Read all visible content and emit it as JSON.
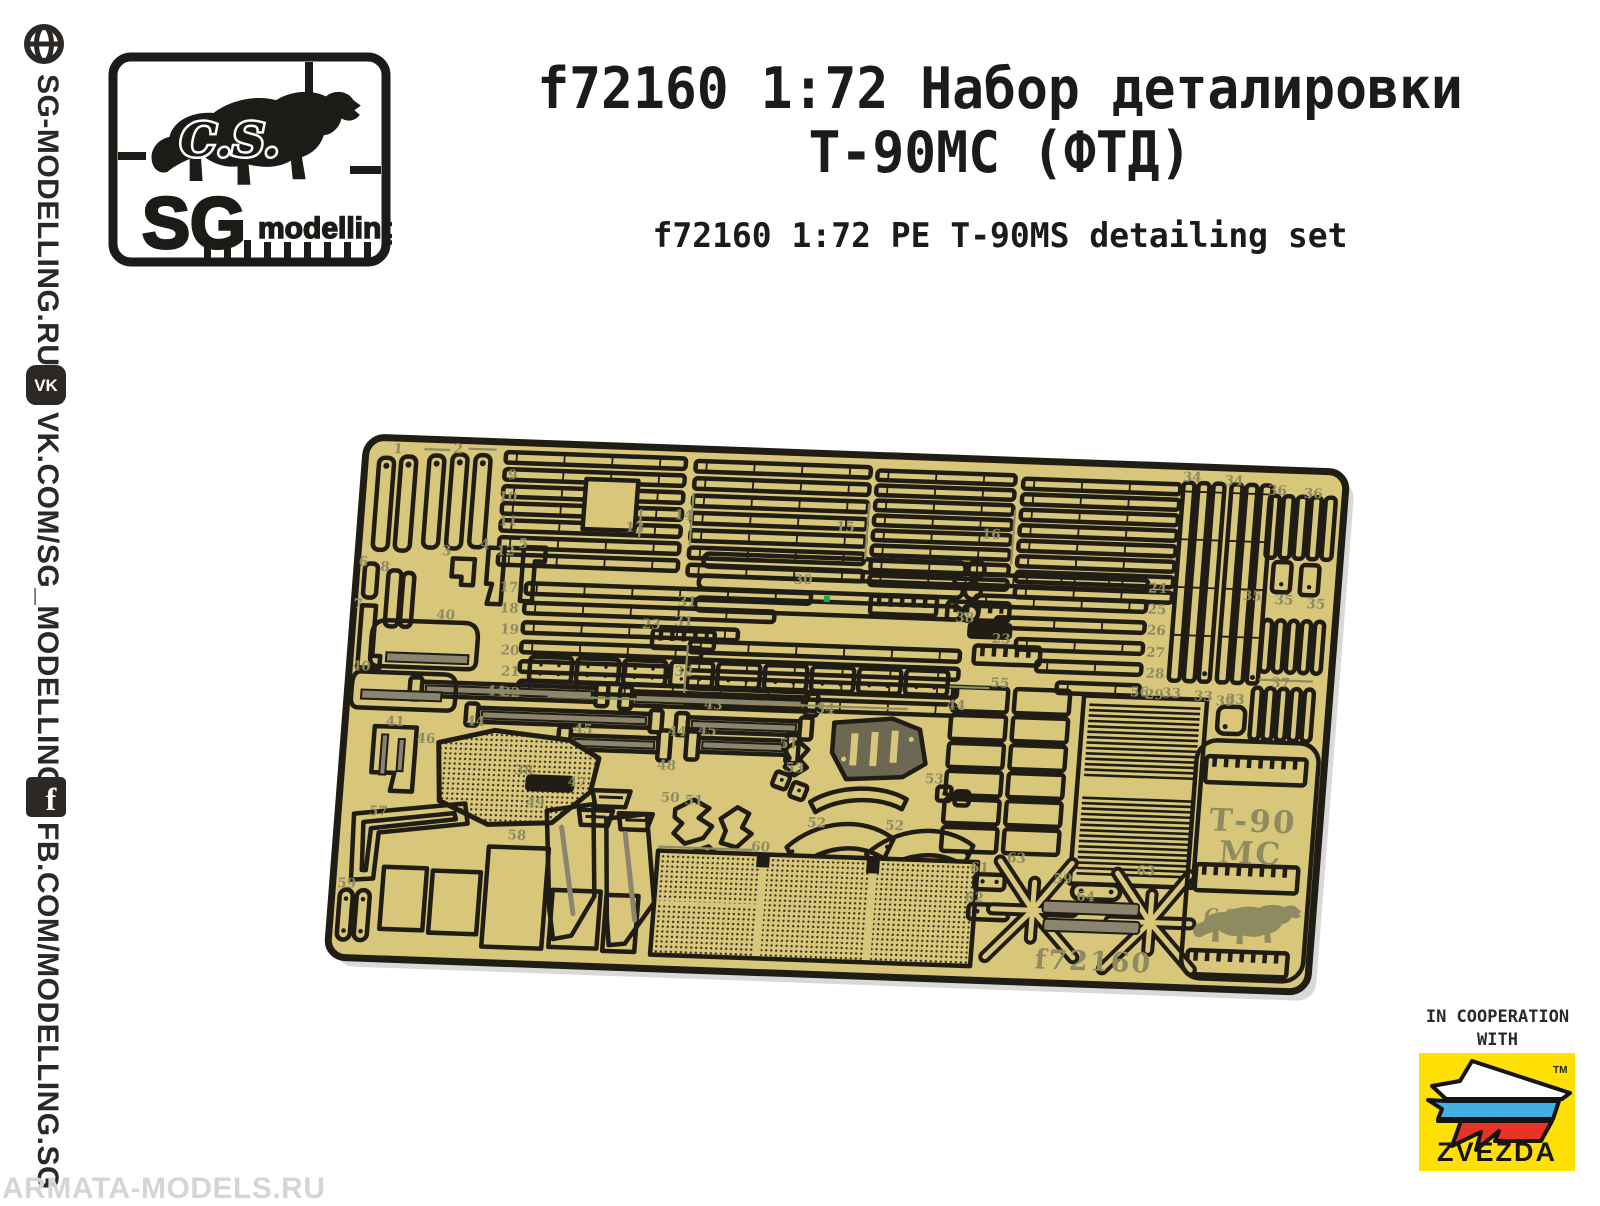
{
  "page": {
    "background": "#ffffff",
    "watermark_text": "ARMATA-MODELS.RU"
  },
  "sidebar": {
    "links": [
      {
        "icon": "globe-icon",
        "text": "SG-MODELLING.RU"
      },
      {
        "icon": "vk-icon",
        "icon_glyph": "VK",
        "text": "VK.COM/SG_MODELLING"
      },
      {
        "icon": "facebook-icon",
        "icon_glyph": "f",
        "text": "FB.COM/MODELLING.SG"
      }
    ]
  },
  "logo": {
    "initials": "C.S.",
    "name_main": "SG",
    "name_sub": "modelling"
  },
  "header": {
    "title_ru_line1": "f72160 1:72 Набор деталировки",
    "title_ru_line2": "Т-90МС (ФТД)",
    "title_en": "f72160 1:72 PE T-90MS detailing set"
  },
  "fret": {
    "colors": {
      "plate": "#d8c67b",
      "outline": "#201d15",
      "etch": "#8f8b61",
      "rod_core": "#8b8570",
      "dark_part": "#6d6851",
      "marker_green": "#18a54e"
    },
    "etched": {
      "code": "f72160",
      "vehicle_line1": "Т-90",
      "vehicle_line2": "МС",
      "bear_initials": "C.S."
    },
    "part_labels": [
      {
        "n": "1",
        "x": 32,
        "y": 10
      },
      {
        "n": "2",
        "x": 92,
        "y": 8
      },
      {
        "n": "3",
        "x": 88,
        "y": 110
      },
      {
        "n": "4",
        "x": 126,
        "y": 102
      },
      {
        "n": "5",
        "x": 164,
        "y": 100
      },
      {
        "n": "6",
        "x": 6,
        "y": 124
      },
      {
        "n": "8",
        "x": 28,
        "y": 128
      },
      {
        "n": "7",
        "x": 4,
        "y": 166
      },
      {
        "n": "9",
        "x": 148,
        "y": 32
      },
      {
        "n": "10",
        "x": 145,
        "y": 54
      },
      {
        "n": "11",
        "x": 147,
        "y": 78
      },
      {
        "n": "12",
        "x": 147,
        "y": 108
      },
      {
        "n": "13",
        "x": 274,
        "y": 80
      },
      {
        "n": "14",
        "x": 322,
        "y": 66
      },
      {
        "n": "15",
        "x": 484,
        "y": 72
      },
      {
        "n": "16",
        "x": 630,
        "y": 74
      },
      {
        "n": "17",
        "x": 153,
        "y": 144
      },
      {
        "n": "18",
        "x": 155,
        "y": 165
      },
      {
        "n": "19",
        "x": 157,
        "y": 186
      },
      {
        "n": "20",
        "x": 159,
        "y": 207
      },
      {
        "n": "21",
        "x": 161,
        "y": 228
      },
      {
        "n": "22",
        "x": 163,
        "y": 249
      },
      {
        "n": "23",
        "x": 298,
        "y": 176
      },
      {
        "n": "23",
        "x": 648,
        "y": 178
      },
      {
        "n": "24",
        "x": 800,
        "y": 122
      },
      {
        "n": "25",
        "x": 801,
        "y": 143
      },
      {
        "n": "26",
        "x": 802,
        "y": 164
      },
      {
        "n": "27",
        "x": 803,
        "y": 186
      },
      {
        "n": "28",
        "x": 804,
        "y": 207
      },
      {
        "n": "29",
        "x": 805,
        "y": 228
      },
      {
        "n": "30",
        "x": 446,
        "y": 126
      },
      {
        "n": "31",
        "x": 332,
        "y": 152
      },
      {
        "n": "31",
        "x": 330,
        "y": 172
      },
      {
        "n": "32",
        "x": 334,
        "y": 222
      },
      {
        "n": "33",
        "x": 822,
        "y": 226
      },
      {
        "n": "33",
        "x": 854,
        "y": 228
      },
      {
        "n": "33",
        "x": 886,
        "y": 230
      },
      {
        "n": "34",
        "x": 826,
        "y": 10
      },
      {
        "n": "34",
        "x": 868,
        "y": 12
      },
      {
        "n": "35",
        "x": 895,
        "y": 126
      },
      {
        "n": "35",
        "x": 927,
        "y": 129
      },
      {
        "n": "35",
        "x": 959,
        "y": 132
      },
      {
        "n": "36",
        "x": 912,
        "y": 20
      },
      {
        "n": "36",
        "x": 948,
        "y": 22
      },
      {
        "n": "37",
        "x": 930,
        "y": 212
      },
      {
        "n": "38",
        "x": 610,
        "y": 158
      },
      {
        "n": "38",
        "x": 182,
        "y": 326
      },
      {
        "n": "39",
        "x": 876,
        "y": 232
      },
      {
        "n": "40",
        "x": 92,
        "y": 174
      },
      {
        "n": "40",
        "x": 12,
        "y": 228
      },
      {
        "n": "41",
        "x": 50,
        "y": 282
      },
      {
        "n": "43",
        "x": 366,
        "y": 254
      },
      {
        "n": "44",
        "x": 148,
        "y": 248
      },
      {
        "n": "44",
        "x": 608,
        "y": 246
      },
      {
        "n": "44",
        "x": 130,
        "y": 279
      },
      {
        "n": "44",
        "x": 332,
        "y": 282
      },
      {
        "n": "45",
        "x": 238,
        "y": 283
      },
      {
        "n": "45",
        "x": 362,
        "y": 280
      },
      {
        "n": "46",
        "x": 82,
        "y": 298
      },
      {
        "n": "47",
        "x": 236,
        "y": 336
      },
      {
        "n": "48",
        "x": 324,
        "y": 316
      },
      {
        "n": "49",
        "x": 196,
        "y": 358
      },
      {
        "n": "50",
        "x": 330,
        "y": 348
      },
      {
        "n": "51",
        "x": 354,
        "y": 350
      },
      {
        "n": "51",
        "x": 444,
        "y": 290
      },
      {
        "n": "52",
        "x": 478,
        "y": 368
      },
      {
        "n": "52",
        "x": 556,
        "y": 368
      },
      {
        "n": "53",
        "x": 452,
        "y": 314
      },
      {
        "n": "53",
        "x": 592,
        "y": 320
      },
      {
        "n": "54",
        "x": 478,
        "y": 254
      },
      {
        "n": "55",
        "x": 650,
        "y": 222
      },
      {
        "n": "56",
        "x": 790,
        "y": 226
      },
      {
        "n": "57",
        "x": 40,
        "y": 372
      },
      {
        "n": "58",
        "x": 180,
        "y": 391
      },
      {
        "n": "59",
        "x": 14,
        "y": 445
      },
      {
        "n": "59",
        "x": 728,
        "y": 415
      },
      {
        "n": "60",
        "x": 424,
        "y": 394
      },
      {
        "n": "61",
        "x": 644,
        "y": 407
      },
      {
        "n": "62",
        "x": 641,
        "y": 437
      },
      {
        "n": "63",
        "x": 680,
        "y": 396
      },
      {
        "n": "63",
        "x": 810,
        "y": 404
      },
      {
        "n": "64",
        "x": 752,
        "y": 432
      }
    ]
  },
  "cooperation": {
    "line1": "IN COOPERATION",
    "line2": "WITH",
    "brand": "ZVEZDA",
    "trademark": "TM",
    "colors": {
      "box": "#ffe005",
      "flag_white": "#ffffff",
      "flag_blue": "#44afe3",
      "flag_red": "#e73226"
    }
  }
}
